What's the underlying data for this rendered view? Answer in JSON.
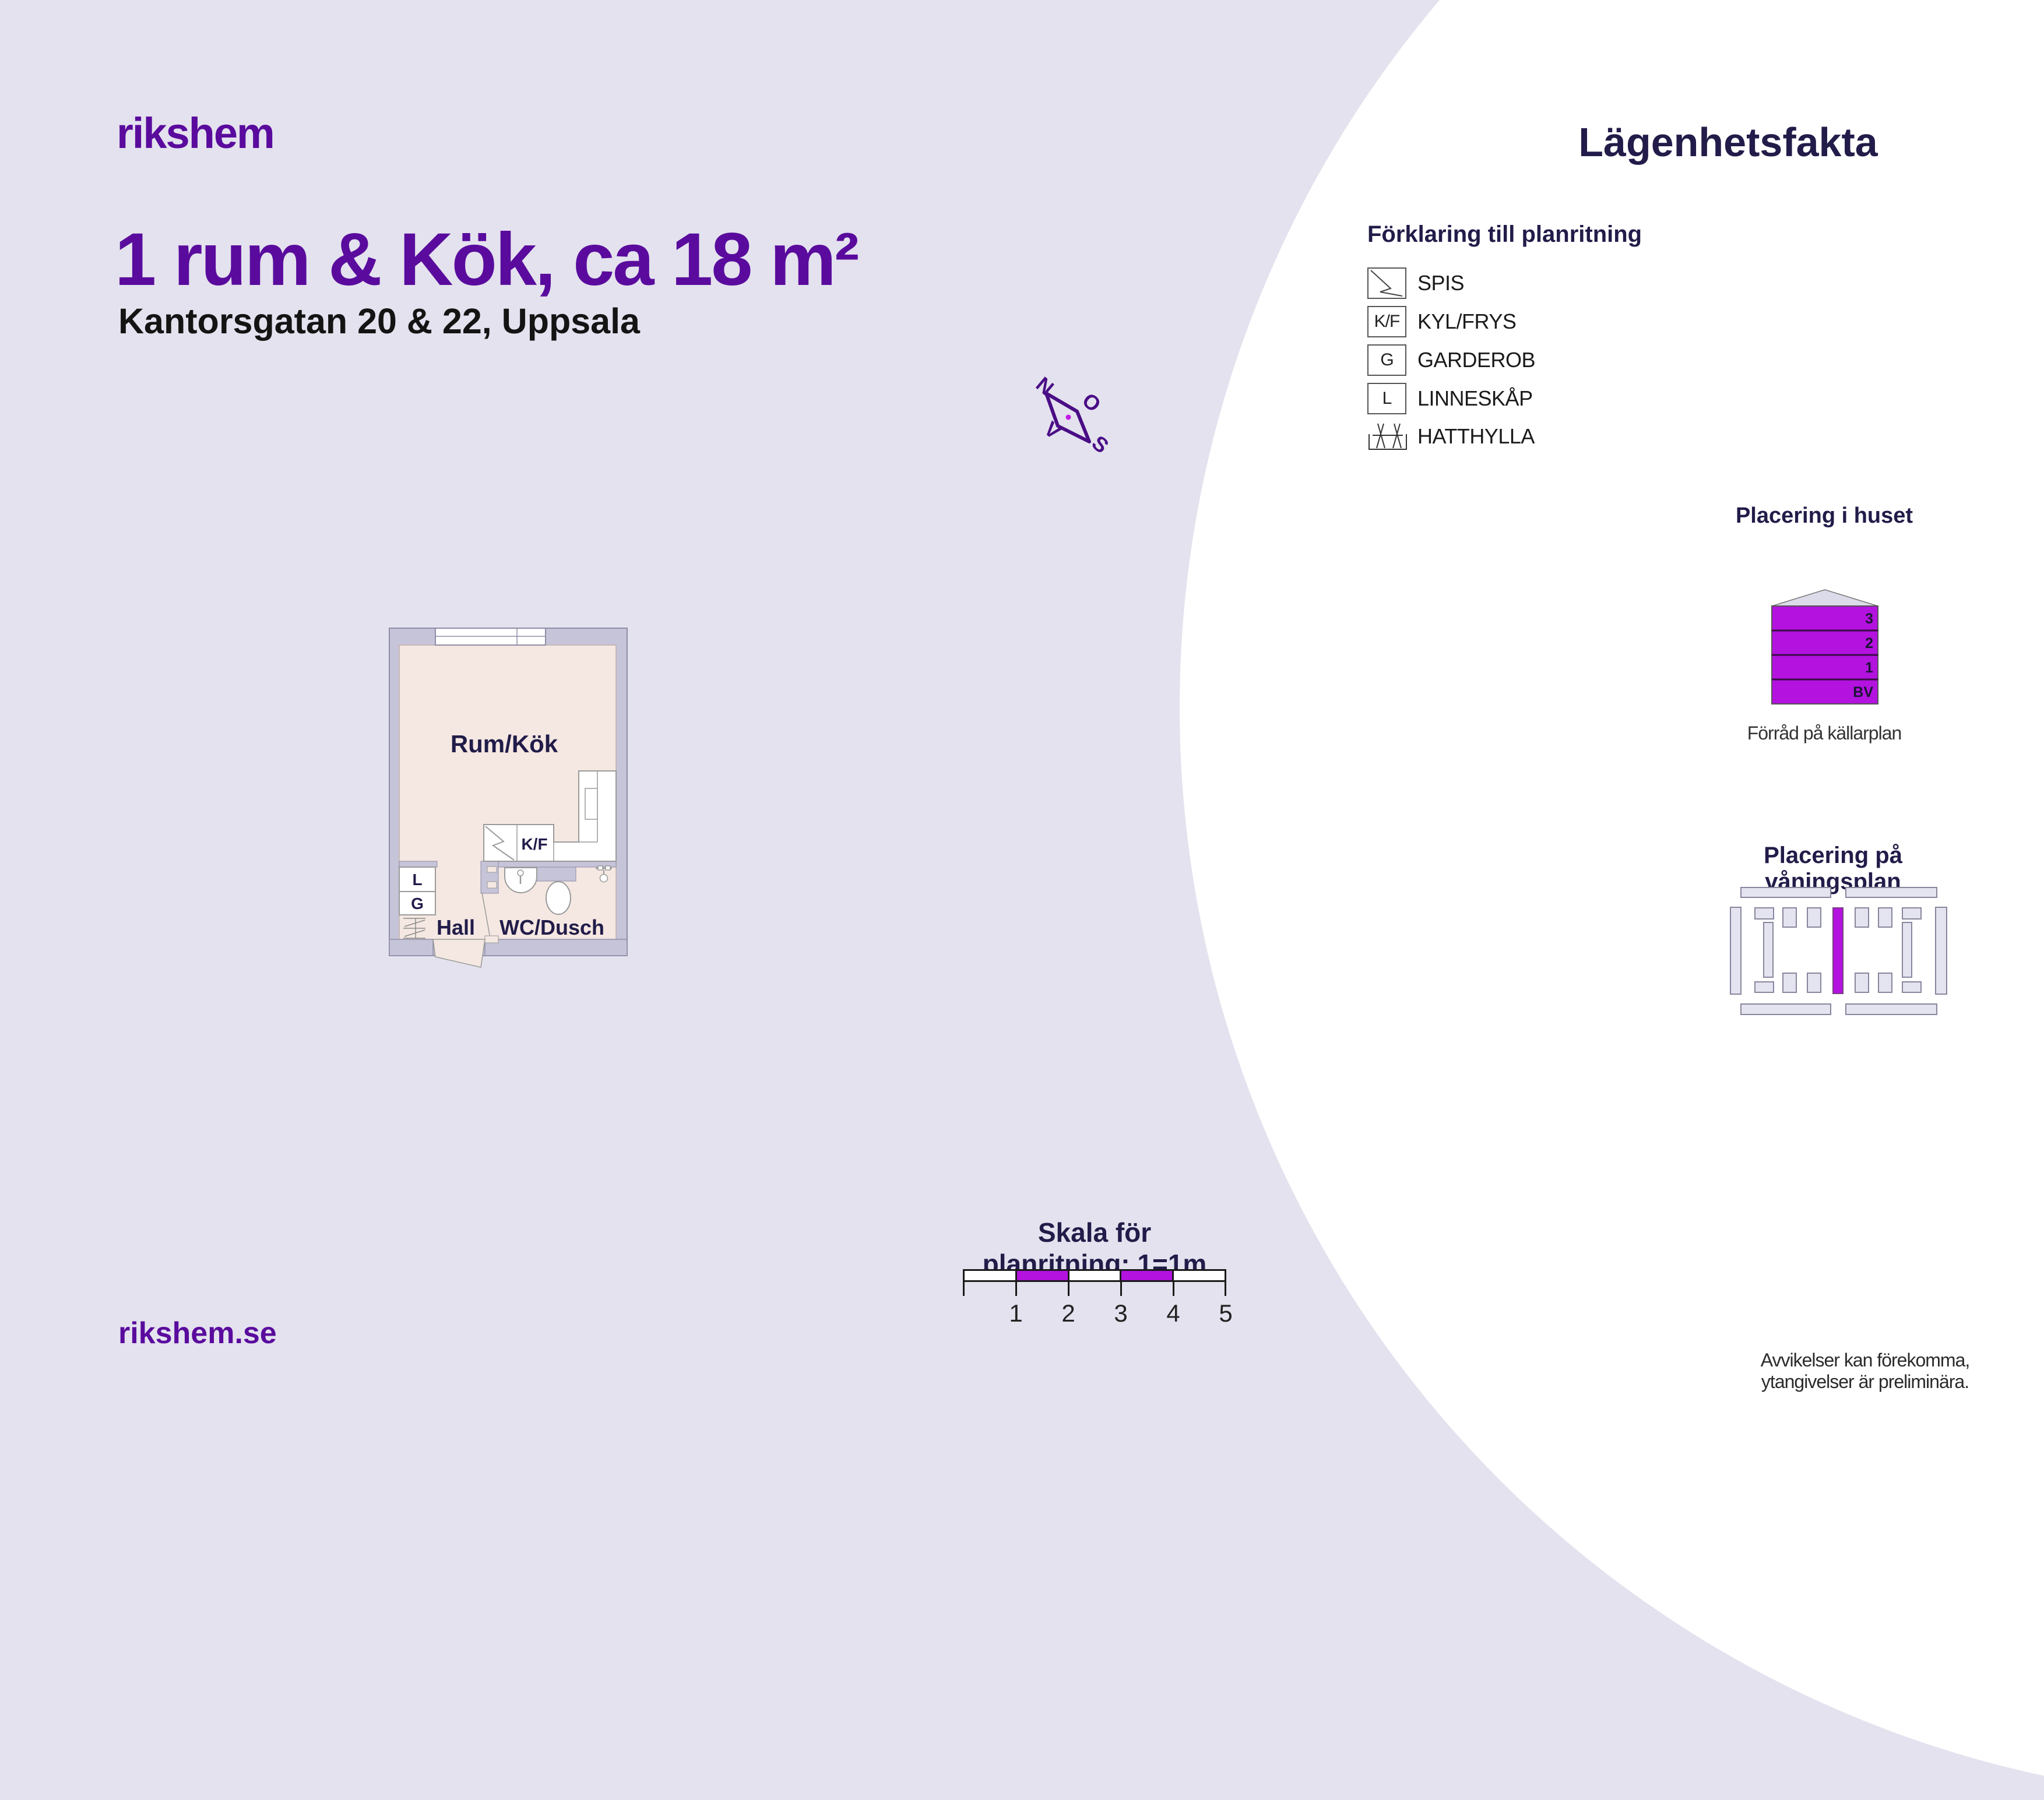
{
  "brand": {
    "logo": "rikshem",
    "website": "rikshem.se"
  },
  "header": {
    "title": "1 rum & Kök, ca 18 m²",
    "address": "Kantorsgatan 20 & 22, Uppsala"
  },
  "facts": {
    "heading": "Lägenhetsfakta",
    "legend": {
      "heading": "Förklaring till planritning",
      "items": [
        {
          "key": "",
          "label": "SPIS"
        },
        {
          "key": "K/F",
          "label": "KYL/FRYS"
        },
        {
          "key": "G",
          "label": "GARDEROB"
        },
        {
          "key": "L",
          "label": "LINNESKÅP"
        },
        {
          "key": "",
          "label": "HATTHYLLA"
        }
      ]
    },
    "building": {
      "heading": "Placering i huset",
      "floors": [
        "3",
        "2",
        "1",
        "BV"
      ],
      "note": "Förråd på källarplan"
    },
    "floor_position": {
      "heading": "Placering på våningsplan"
    }
  },
  "floorplan": {
    "rooms": {
      "main": "Rum/Kök",
      "hall": "Hall",
      "wc": "WC/Dusch"
    },
    "fixtures": {
      "kf": "K/F",
      "l": "L",
      "g": "G"
    }
  },
  "compass": {
    "n": "N",
    "o": "O",
    "s": "S",
    "v": "V"
  },
  "scale": {
    "heading": "Skala för planritning: 1=1m",
    "numbers": [
      "1",
      "2",
      "3",
      "4",
      "5"
    ]
  },
  "footer": {
    "disclaimer_line1": "Avvikelser kan förekomma,",
    "disclaimer_line2": "ytangivelser är preliminära."
  },
  "colors": {
    "purple": "#5a0b9d",
    "navy": "#211c49",
    "magenta": "#b312df",
    "background": "#e3e2ee",
    "wall": "#c6c4d8",
    "floor": "#f5e8e2"
  }
}
